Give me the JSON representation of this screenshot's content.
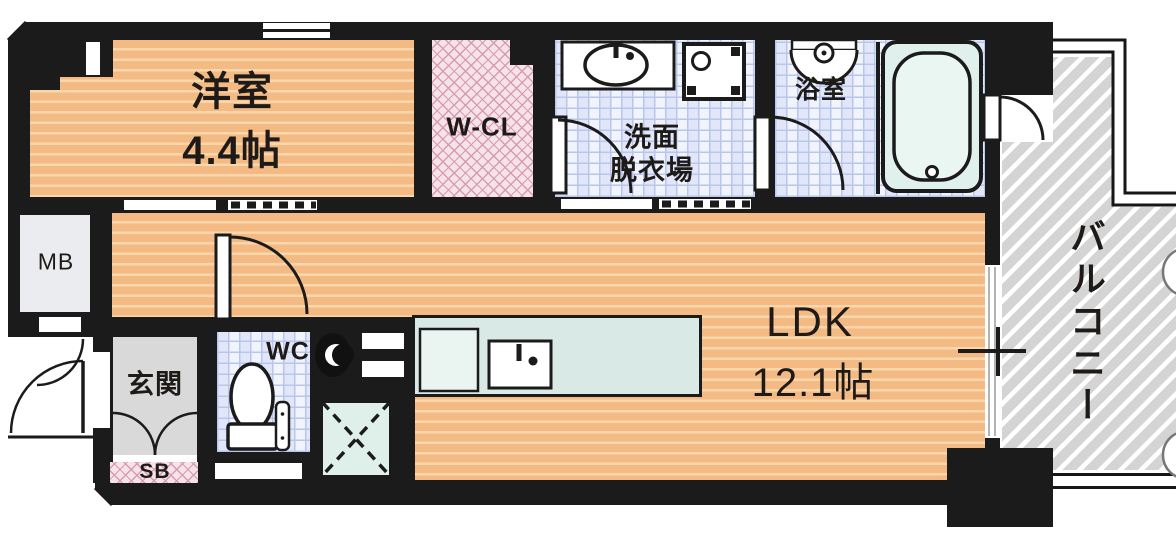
{
  "floorplan": {
    "type": "apartment-floor-plan",
    "rooms": {
      "western_room": {
        "name": "洋室",
        "size": "4.4帖"
      },
      "walk_in_closet": {
        "name": "W-CL"
      },
      "washroom": {
        "name_line1": "洗面",
        "name_line2": "脱衣場"
      },
      "bathroom": {
        "name": "浴室"
      },
      "ldk": {
        "name": "LDK",
        "size": "12.1帖"
      },
      "entrance": {
        "name": "玄関"
      },
      "toilet_room": {
        "name": "WC"
      },
      "meter_box": {
        "name": "MB"
      },
      "shoe_box": {
        "name": "SB"
      },
      "balcony": {
        "name": "バルコニー"
      }
    },
    "colors": {
      "wall": "#1b1b1b",
      "text": "#1e1a17",
      "floor_orange": "#f4ba84",
      "floor_orange_light": "#fad6ac",
      "wet_bg": "#f1f4fc",
      "wet_line": "#b9c6ec",
      "pink_bg": "#f6e3e9",
      "pink_line": "#d79bb1",
      "gray_floor": "#d9d9d9",
      "balcony_gray": "#d4d4d4",
      "fixture_cyan": "#d9eae6",
      "tub_cyan": "#e0f0ec",
      "xbox_cyan": "#dff0eb",
      "mb_fill": "#ebecf0"
    }
  }
}
